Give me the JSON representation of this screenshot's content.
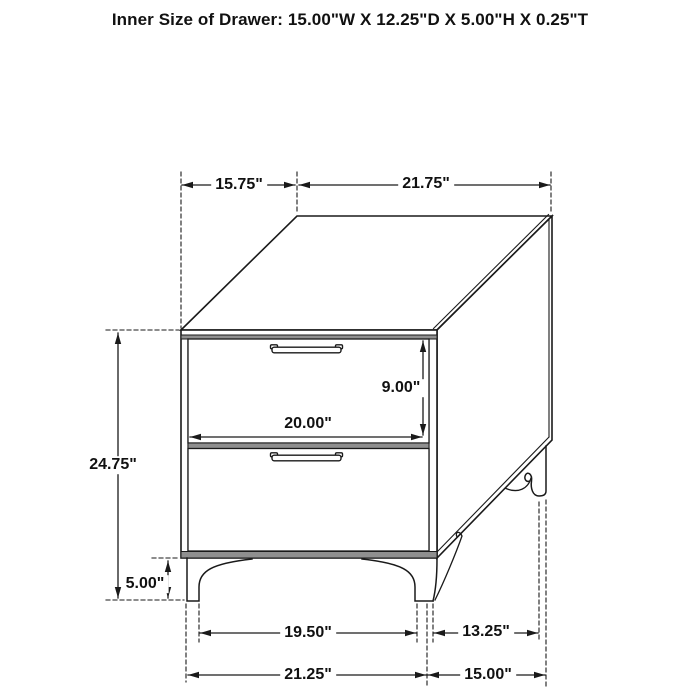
{
  "title": "Inner Size of Drawer: 15.00\"W X 12.25\"D X 5.00\"H X 0.25\"T",
  "figure": {
    "type": "furniture-dimension-diagram",
    "subject": "two-drawer nightstand line drawing",
    "colors": {
      "line": "#1a1a1a",
      "panel_shadow": "#8f8f8f",
      "background": "#ffffff"
    },
    "dimensions": {
      "top_depth": "15.75\"",
      "top_width": "21.75\"",
      "drawer_front_height": "9.00\"",
      "drawer_front_width": "20.00\"",
      "overall_height": "24.75\"",
      "leg_height": "5.00\"",
      "front_leg_spacing": "19.50\"",
      "side_leg_spacing": "13.25\"",
      "front_base_width": "21.25\"",
      "side_base_depth": "15.00\""
    }
  }
}
